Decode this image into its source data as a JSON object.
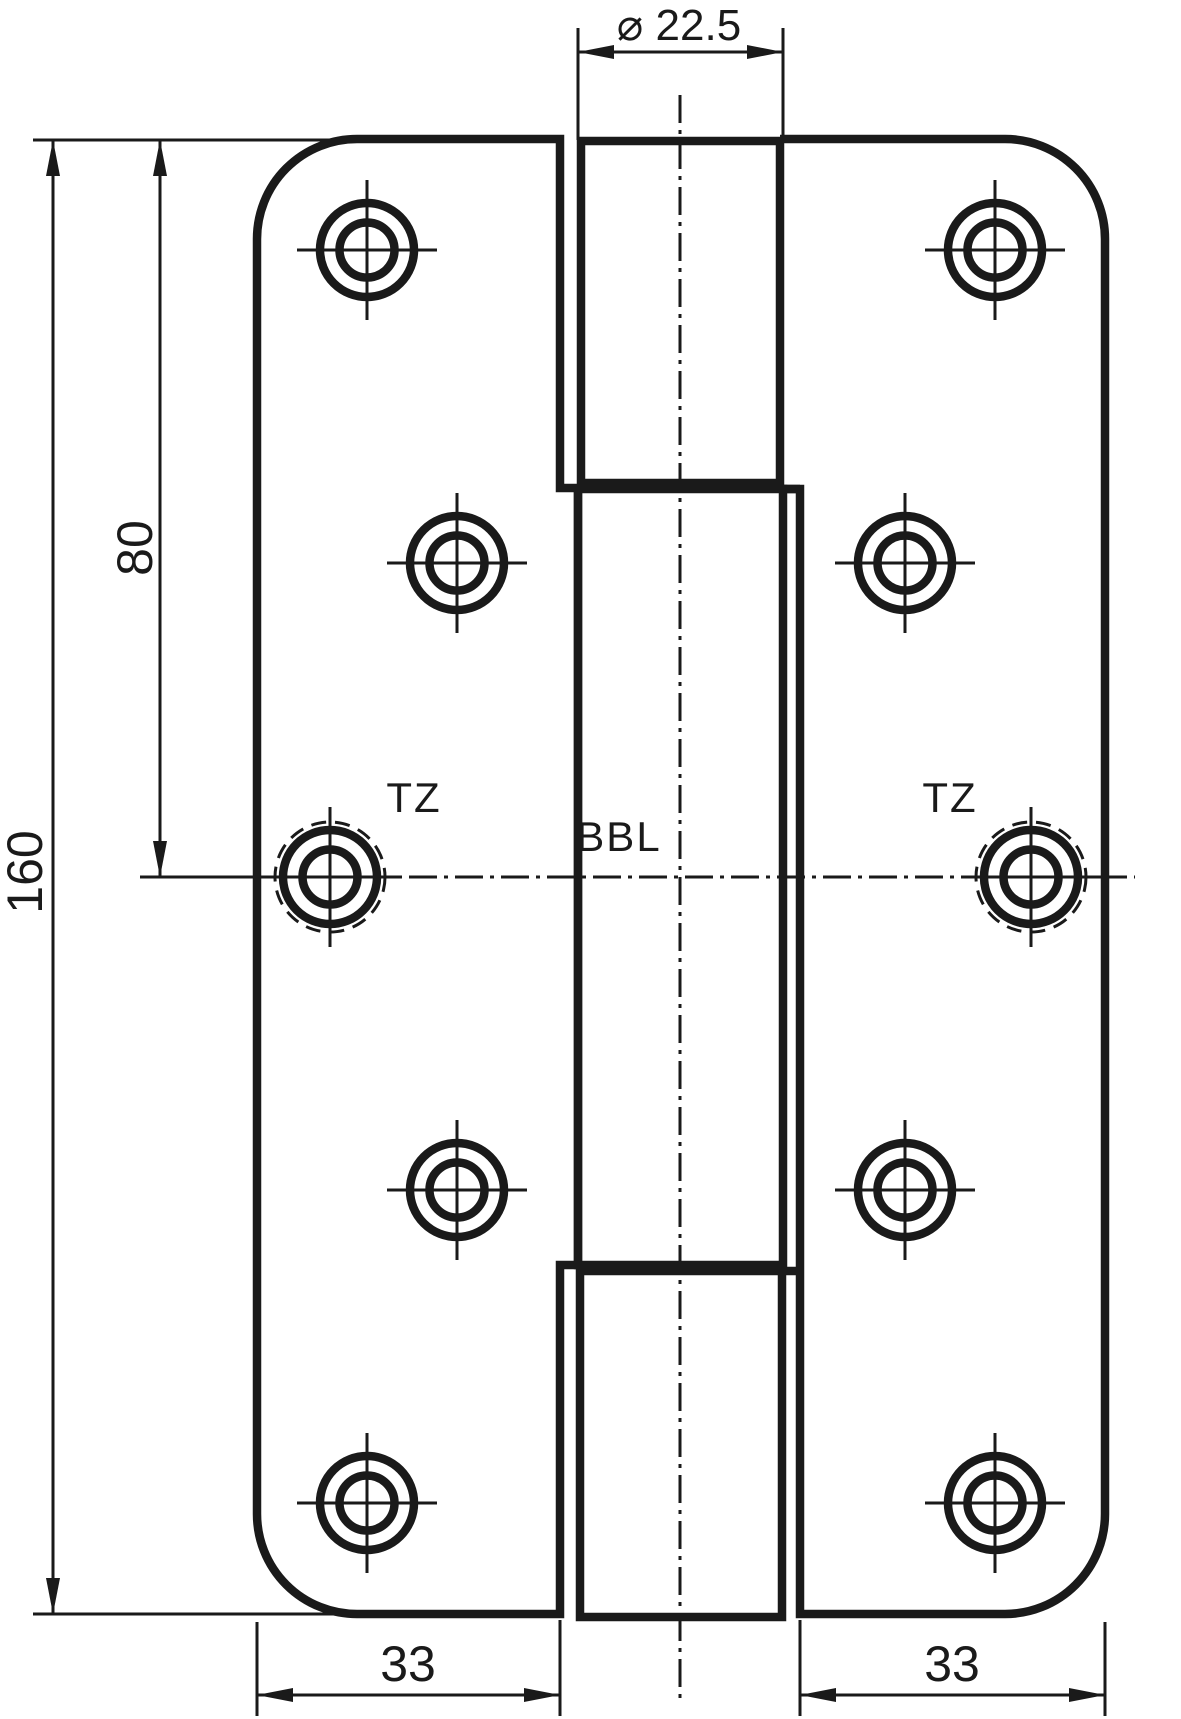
{
  "drawing": {
    "title": "door-hinge-technical-drawing-front-view",
    "colors": {
      "line": "#1a1a1a",
      "background": "#ffffff"
    },
    "labels": {
      "tz_left": "TZ",
      "tz_right": "TZ",
      "bbl": "BBL"
    },
    "dimensions": {
      "barrel_diameter": "⌀ 22.5",
      "total_height": "160",
      "upper_half_height": "80",
      "left_leaf_width": "33",
      "right_leaf_width": "33"
    },
    "holes": [
      {
        "cx": 367,
        "cy": 250,
        "dashed": false
      },
      {
        "cx": 995,
        "cy": 250,
        "dashed": false
      },
      {
        "cx": 457,
        "cy": 563,
        "dashed": false
      },
      {
        "cx": 905,
        "cy": 563,
        "dashed": false
      },
      {
        "cx": 330,
        "cy": 877,
        "dashed": true
      },
      {
        "cx": 1031,
        "cy": 877,
        "dashed": true
      },
      {
        "cx": 457,
        "cy": 1190,
        "dashed": false
      },
      {
        "cx": 905,
        "cy": 1190,
        "dashed": false
      },
      {
        "cx": 367,
        "cy": 1503,
        "dashed": false
      },
      {
        "cx": 995,
        "cy": 1503,
        "dashed": false
      }
    ]
  }
}
